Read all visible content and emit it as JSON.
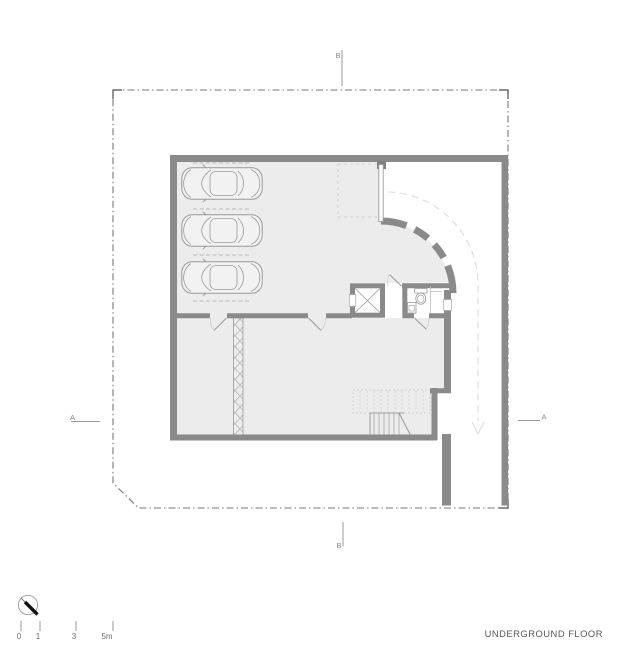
{
  "title": "UNDERGROUND FLOOR",
  "section_markers": {
    "a": "A",
    "b": "B"
  },
  "scale_bar": {
    "tick_labels": [
      "0",
      "1",
      "3",
      "5m"
    ]
  },
  "plan": {
    "type": "architectural-floor-plan",
    "parked_cars": 3,
    "elements": [
      "parking-garage",
      "elevator",
      "bathroom",
      "stairs",
      "curved-driveway-ramp",
      "storage-rooms",
      "property-boundary"
    ]
  },
  "colors": {
    "wall": "#8a8a8a",
    "floor": "#ececec",
    "thin_outline": "#9a9a9a",
    "light_dash": "#c7c7c7",
    "driveway_dash": "#dcdcdc",
    "boundary": "#787878",
    "text": "#585858",
    "compass_needle": "#111111",
    "background": "#ffffff"
  }
}
